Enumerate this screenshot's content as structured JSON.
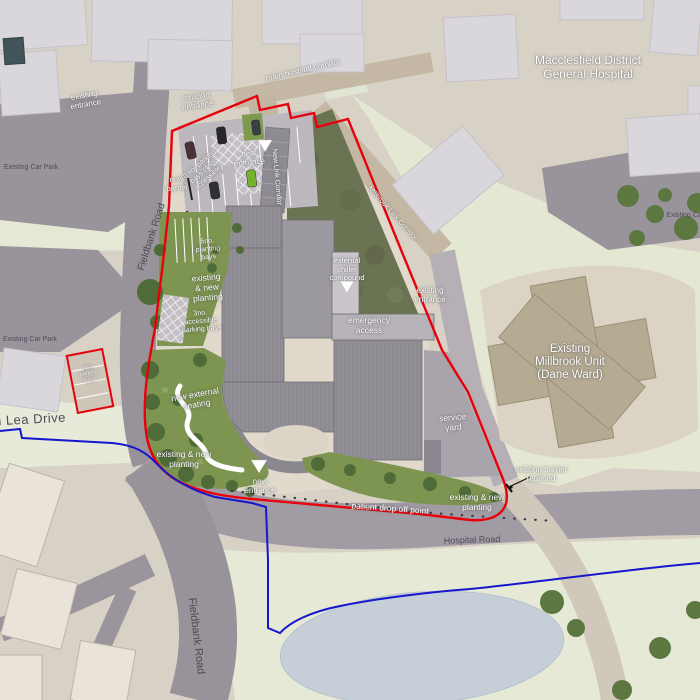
{
  "title": "Macclesfield District General Hospital site plan",
  "colors": {
    "background": "#d7d1c6",
    "road_gray": "#98929b",
    "pale_green": "#e4e8d2",
    "courtyard_green": "#6b7452",
    "planting_green": "#7d9551",
    "tree_green": "#4f6b38",
    "building_light": "#dad7dc",
    "building_roof": "#918e95",
    "corridor_tan": "#c4b8a5",
    "millbrook_unit_tan": "#b5ab93",
    "pond_blue": "#c6cfd8",
    "site_boundary_red": "#e8000b",
    "secondary_boundary_blue": "#1616cc",
    "label_dark": "#4c4c55",
    "label_white": "#ffffff"
  },
  "labels": [
    {
      "id": "hospital-name",
      "text": "Macclesfield District\nGeneral Hospital"
    },
    {
      "id": "existing-entrance-west",
      "text": "existing\nentrance"
    },
    {
      "id": "existing-entrance-north",
      "text": "existing\nentrance"
    },
    {
      "id": "main-hospital-corridor",
      "text": "main hospital corridor"
    },
    {
      "id": "existing-car-park-1",
      "text": "Existing Car Park"
    },
    {
      "id": "fieldbank-road-north",
      "text": "Fieldbank Road"
    },
    {
      "id": "new-barrier",
      "text": "new\nbarrier"
    },
    {
      "id": "parking-bays-note",
      "text": "10 no. parking\nbays (4no.\naccessible)"
    },
    {
      "id": "new-entrance-north",
      "text": "new\nentrance"
    },
    {
      "id": "new-link-corridor",
      "text": "New Link Corridor"
    },
    {
      "id": "millbrook-link-corridor",
      "text": "Millbrook Link Corridor"
    },
    {
      "id": "planting-bays-5no",
      "text": "5no.\nplanting\nbays"
    },
    {
      "id": "existing-new-planting-west",
      "text": "existing\n& new\nplanting"
    },
    {
      "id": "external-chiller",
      "text": "external\nchiller\ncompound"
    },
    {
      "id": "existing-entrance-east",
      "text": "existing\nentrance"
    },
    {
      "id": "emergency-access",
      "text": "emergency\naccess"
    },
    {
      "id": "accessible-bays-3no",
      "text": "3no.\naccessible\nparking bays"
    },
    {
      "id": "existing-car-park-2",
      "text": "Existing Car Park"
    },
    {
      "id": "millbrook-unit",
      "text": "Existing\nMillbrook Unit\n(Dane Ward)"
    },
    {
      "id": "service-yard",
      "text": "service\nyard"
    },
    {
      "id": "new-external-seating",
      "text": "new external\nseating"
    },
    {
      "id": "existing-new-planting-sw",
      "text": "existing & new\nplanting"
    },
    {
      "id": "new-entrance-south",
      "text": "new\nentrance"
    },
    {
      "id": "patient-drop-off",
      "text": "patient drop off point"
    },
    {
      "id": "existing-new-planting-se",
      "text": "existing & new\nplanting"
    },
    {
      "id": "existing-barrier-retained",
      "text": "existing barrier\nretained"
    },
    {
      "id": "hospital-road",
      "text": "Hospital Road"
    },
    {
      "id": "lea-drive",
      "text": "n Lea Drive"
    },
    {
      "id": "fieldbank-road-south",
      "text": "Fieldbank Road"
    },
    {
      "id": "existing-car-park-3",
      "text": "Existing Ca"
    },
    {
      "id": "red-box-note",
      "text": "5no.\nparking\nbays"
    }
  ]
}
